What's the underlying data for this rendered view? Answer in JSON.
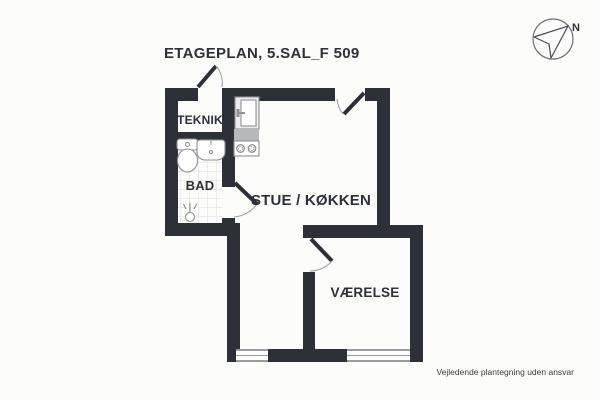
{
  "title": "ETAGEPLAN, 5.SAL_F 509",
  "compass": {
    "label": "N",
    "icon": "compass-north-icon"
  },
  "rooms": {
    "teknik": {
      "label": "TEKNIK"
    },
    "bad": {
      "label": "BAD"
    },
    "stue": {
      "label": "STUE / KØKKEN"
    },
    "vaerelse": {
      "label": "VÆRELSE"
    }
  },
  "footer": {
    "disclaimer": "Vejledende plantegning uden ansvar"
  },
  "symbols": [
    "toilet-symbol",
    "bath-sink-symbol",
    "shower-symbol",
    "kitchen-sink-symbol",
    "counter-symbol",
    "stove-symbol",
    "door-leaf",
    "door-arc",
    "window-symbol",
    "tile-floor"
  ],
  "colors": {
    "wall": "#2d3036",
    "background": "#fcfcfb",
    "fixture_outline": "#8f9296",
    "counter_fill": "#b6b8ba",
    "tile_line": "#dddddd",
    "door_arc": "#9aa0a5",
    "text": "#2d3036"
  }
}
